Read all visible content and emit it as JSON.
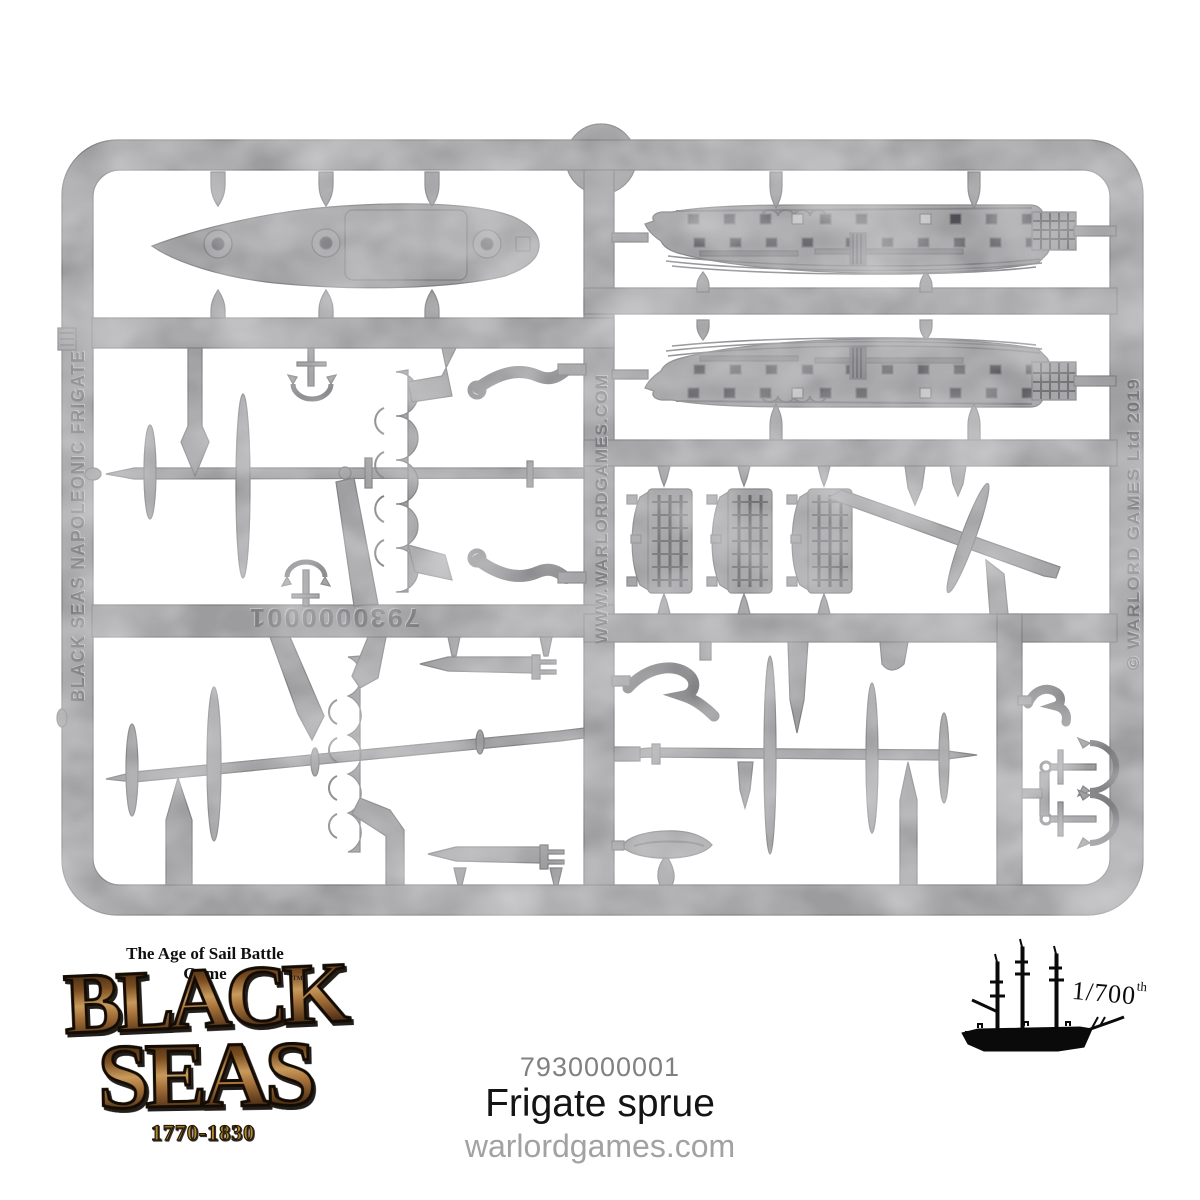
{
  "page": {
    "background_color": "#ffffff"
  },
  "sprue": {
    "plastic_color": "#9c9c9f",
    "detail_color": "#4e4e52",
    "left_rail_text": "BLACK SEAS NAPOLEONIC FRIGATE",
    "center_bar_text": "WWW.WARLORDGAMES.COM",
    "right_rail_text": "© WARLORD GAMES Ltd 2019",
    "mold_number": "7930000001"
  },
  "footer": {
    "logo": {
      "tagline": "The Age of Sail Battle Game",
      "title_word1": "BLACK",
      "title_word2": "SEAS",
      "trademark": "™",
      "years": "1770-1830",
      "brown_color": "#8a5a28",
      "gold_color": "#b3892f"
    },
    "product_code": "7930000001",
    "product_name": "Frigate sprue",
    "website": "warlordgames.com",
    "scale": {
      "value": "1/700",
      "suffix": "th"
    },
    "ship_icon": "three-masted-frigate-silhouette"
  }
}
